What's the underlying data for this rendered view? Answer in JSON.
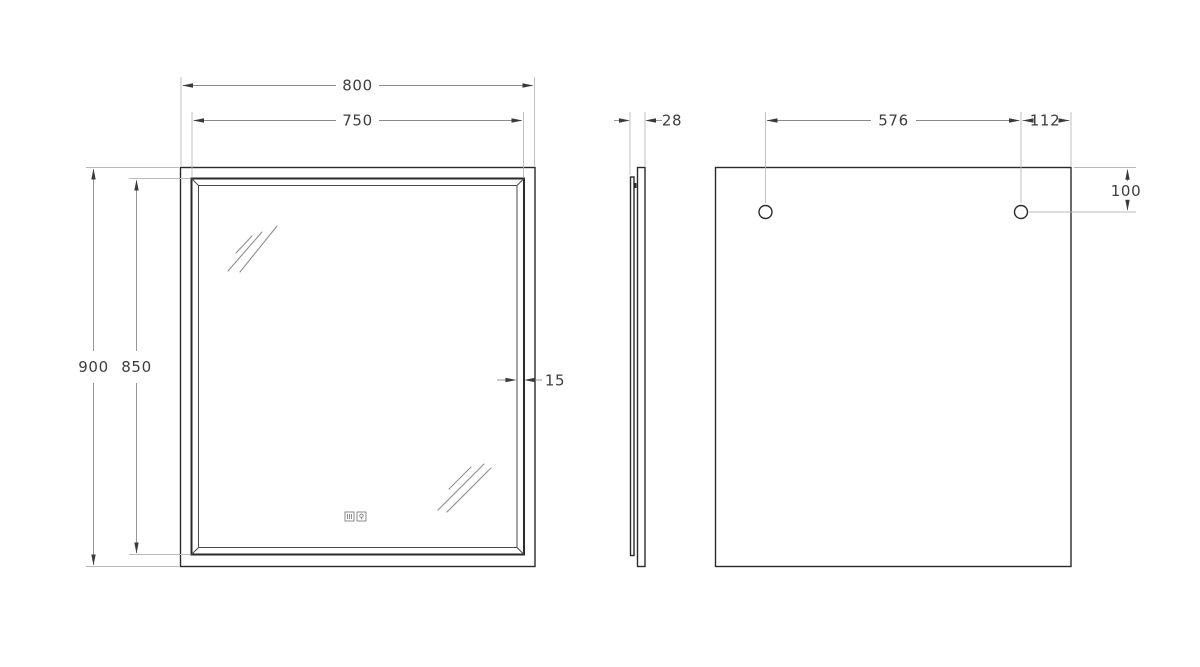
{
  "drawing": {
    "type": "mirror-technical-drawing",
    "front": {
      "width_outer": "800",
      "width_glass": "750",
      "height_outer": "900",
      "height_glass": "850",
      "frame_bevel_width": "15"
    },
    "side": {
      "depth": "28"
    },
    "back": {
      "hole_spacing": "576",
      "hole_to_edge": "112",
      "hole_from_top": "100"
    }
  },
  "icons": {
    "left": "anti-fog-touch-icon",
    "right": "light-touch-icon"
  },
  "colors": {
    "bg": "#ffffff",
    "outline": "#2a2a2a",
    "dimension": "#8a8a8a",
    "arrow": "#3a3a3a",
    "extension": "#b9b9b9",
    "text": "#3d3d3d",
    "glint": "#8f8f8f",
    "icon": "#6f6f6f"
  }
}
